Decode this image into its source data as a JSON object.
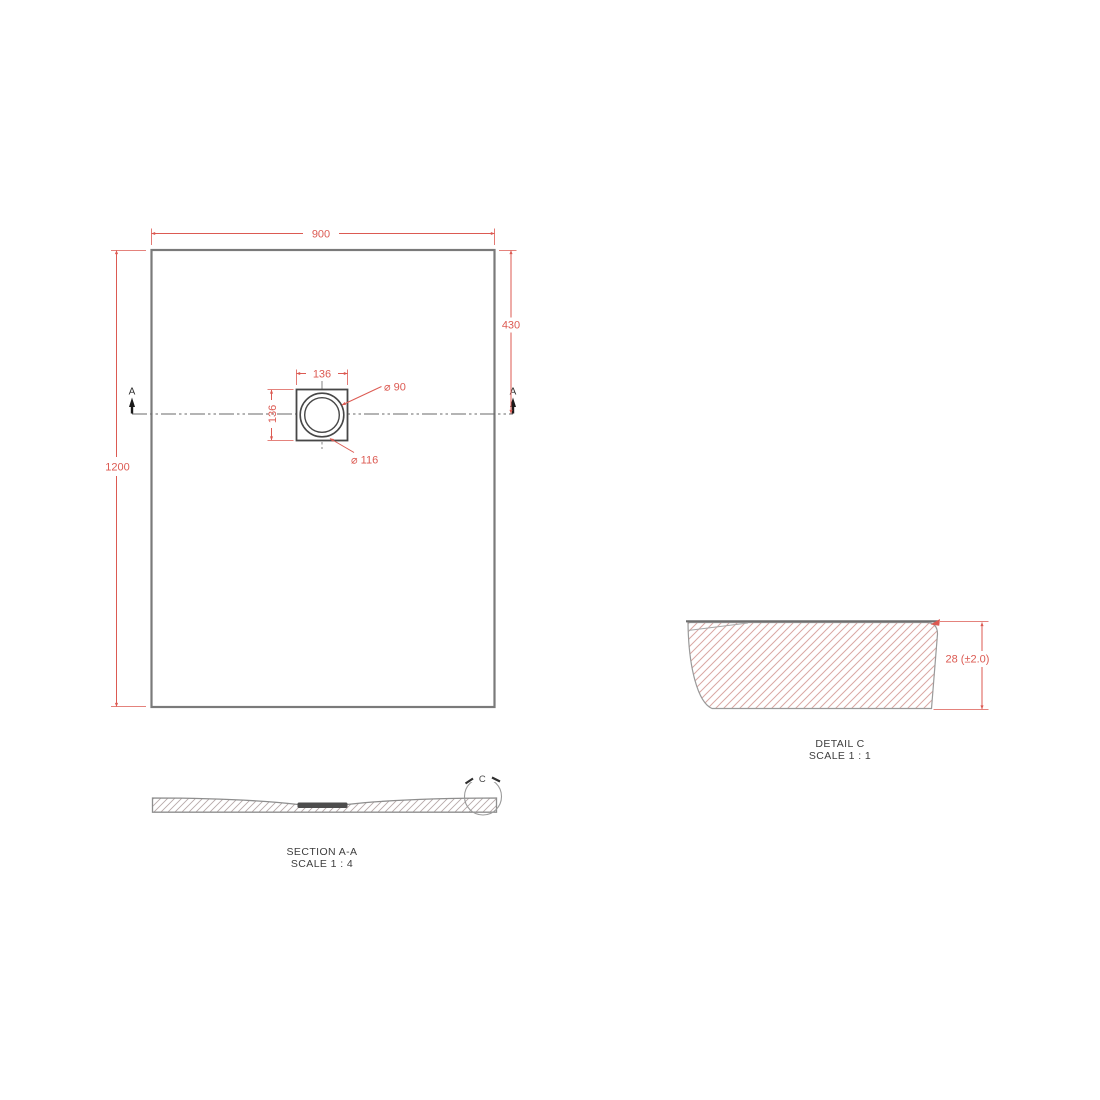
{
  "plan": {
    "width_dim": "900",
    "height_dim": "1200",
    "drain_offset_dim": "430",
    "drain_width_dim": "136",
    "drain_height_dim": "136",
    "drain_hole_dia": "⌀ 90",
    "drain_flange_dia": "⌀ 116",
    "section_marker_left": "A",
    "section_marker_right": "A"
  },
  "section": {
    "title": "SECTION A-A",
    "scale": "SCALE 1 : 4",
    "detail_marker": "C"
  },
  "detail": {
    "title": "DETAIL C",
    "scale": "SCALE 1 : 1",
    "thickness_dim": "28 (±2.0)"
  },
  "colors": {
    "dimension_red": "#dc5a52",
    "hatch_red": "#d9a7a3",
    "hatch_gray": "#b7a9a9",
    "edge_gray": "#7a7a7a",
    "text_dark": "#3d3d3d"
  }
}
